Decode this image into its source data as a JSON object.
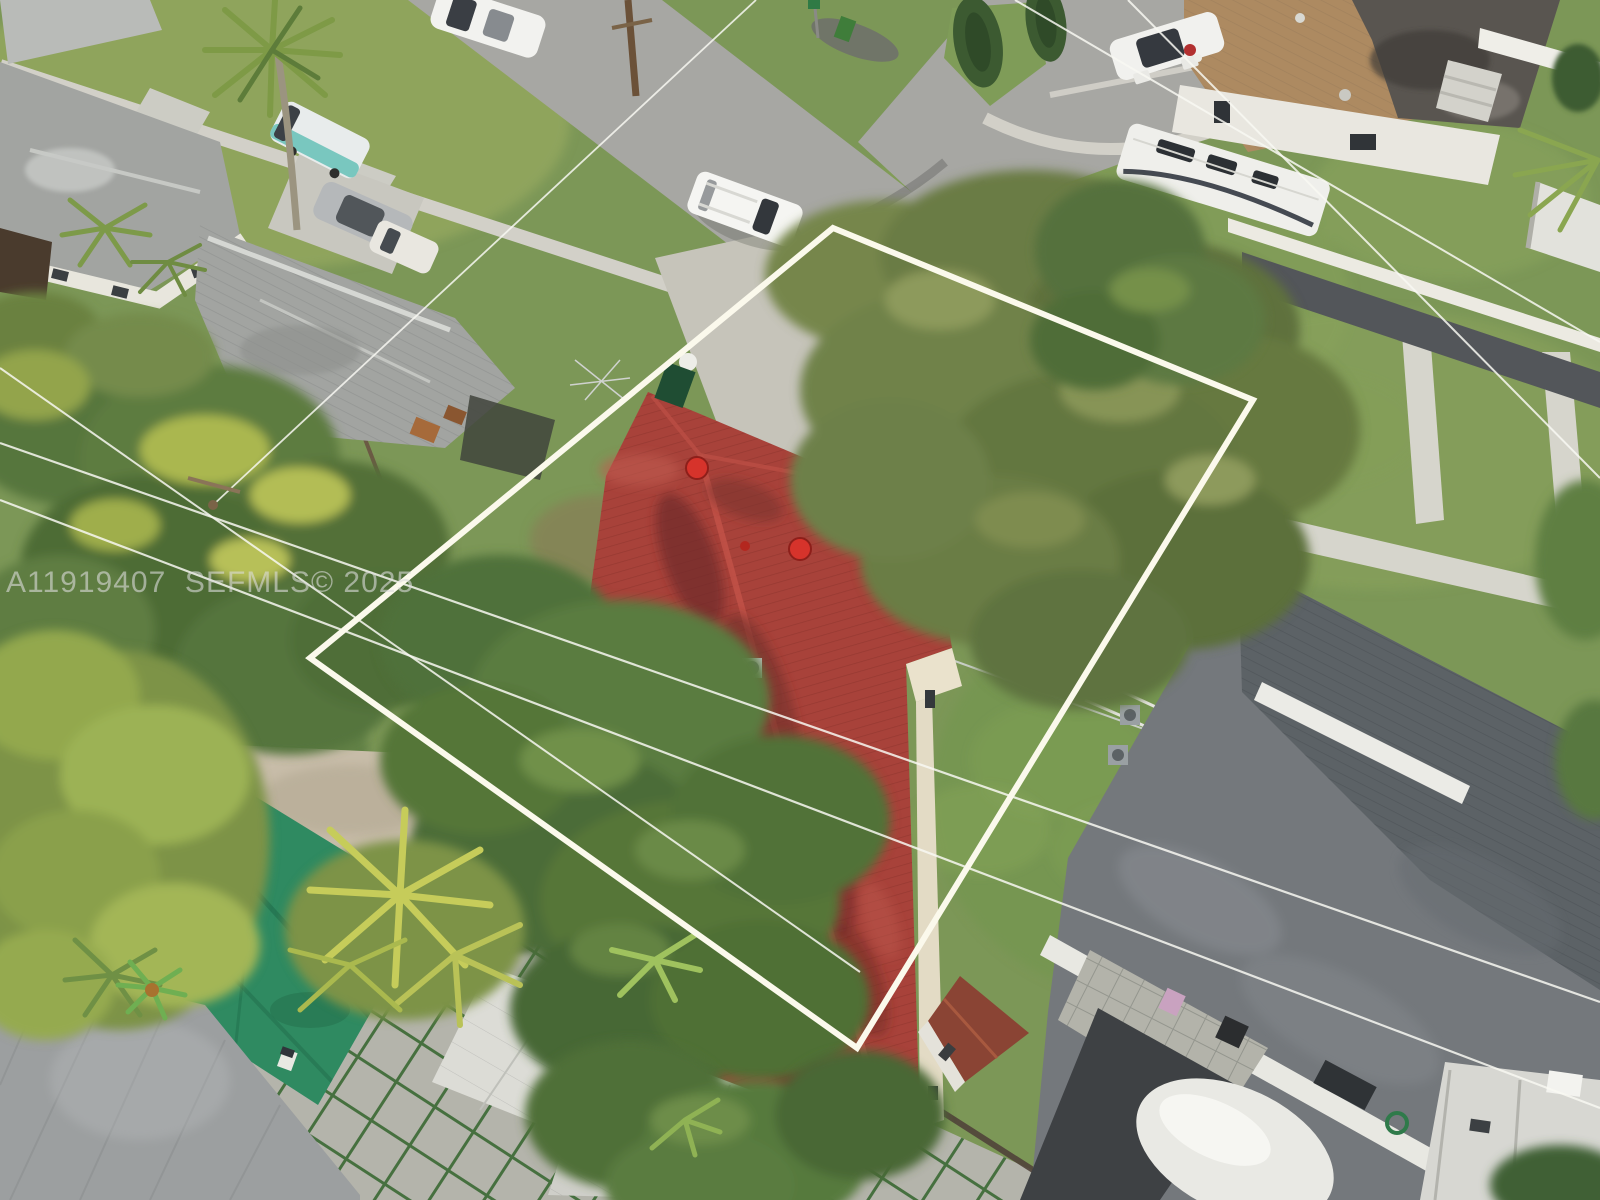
{
  "meta": {
    "media_type": "aerial drone photograph",
    "subject": "Residential lot with red shingle roof house outlined by white property-boundary overlay in a suburban neighborhood"
  },
  "watermark": {
    "text": "A11919407  SEFMLS© 2025",
    "mls_number": "A11919407",
    "source": "SEFMLS©",
    "year": "2025"
  },
  "overlay": {
    "boundary_shape": "quadrilateral",
    "boundary_color": "#FBF9EC"
  },
  "colors": {
    "grass": "#7C9757",
    "road": "#A7A7A3",
    "sidewalk": "#D2D0C8",
    "subject_roof": "#A8423A",
    "subject_roof_streak": "#6B2D28",
    "neighbor_roof_dark": "#74787C",
    "neighbor_roof_gray": "#A2A4A1",
    "mobile_home_roof_tan": "#AD8A61",
    "turf": "#2F8A61",
    "paver": "#B4B4AB",
    "sand": "#C8BDA9",
    "boundary": "#FBF9EC",
    "watermark_gray": "#DCDCDC"
  },
  "scene": {
    "center": [
      "property-boundary-overlay",
      "red-shingle-hip-roof",
      "roof-vent-caps",
      "concrete-driveway",
      "large-tree-canopy",
      "backyard-lawn",
      "ac-unit"
    ],
    "top": [
      "street-intersection",
      "grass-median-island",
      "parked-white-suv",
      "parked-white-tahoe",
      "green-trash-bin",
      "street-sign",
      "utility-pole"
    ],
    "top_left": [
      "gray-roof-house",
      "white-house-gray-roof",
      "royal-palm",
      "teal-van",
      "silver-sedan",
      "concrete-driveway"
    ],
    "top_right": [
      "mobile-home-tan-roof",
      "white-travel-trailer",
      "parked-sedan-doors-open",
      "white-fence",
      "backyard-shed",
      "concrete-steps"
    ],
    "right": [
      "dark-gray-shingle-roof-house",
      "white-ridge-vent",
      "paver-patio",
      "pink-chair",
      "black-grill",
      "white-boat-cover-dome",
      "asphalt-driveway",
      "front-walkways",
      "garden-hose"
    ],
    "bottom_left": [
      "artificial-turf-patch",
      "yellow-palm-cluster",
      "sandy-yard",
      "paver-grid-green-joints",
      "gray-metal-roof",
      "housewrap-covered-sheds",
      "boat-with-outboards",
      "blue-tarp",
      "toy-car"
    ],
    "bottom": [
      "wood-fence",
      "red-roof-shed",
      "banana-plants",
      "tree-canopy"
    ],
    "across": [
      "overhead-power-lines",
      "mls-watermark"
    ]
  }
}
